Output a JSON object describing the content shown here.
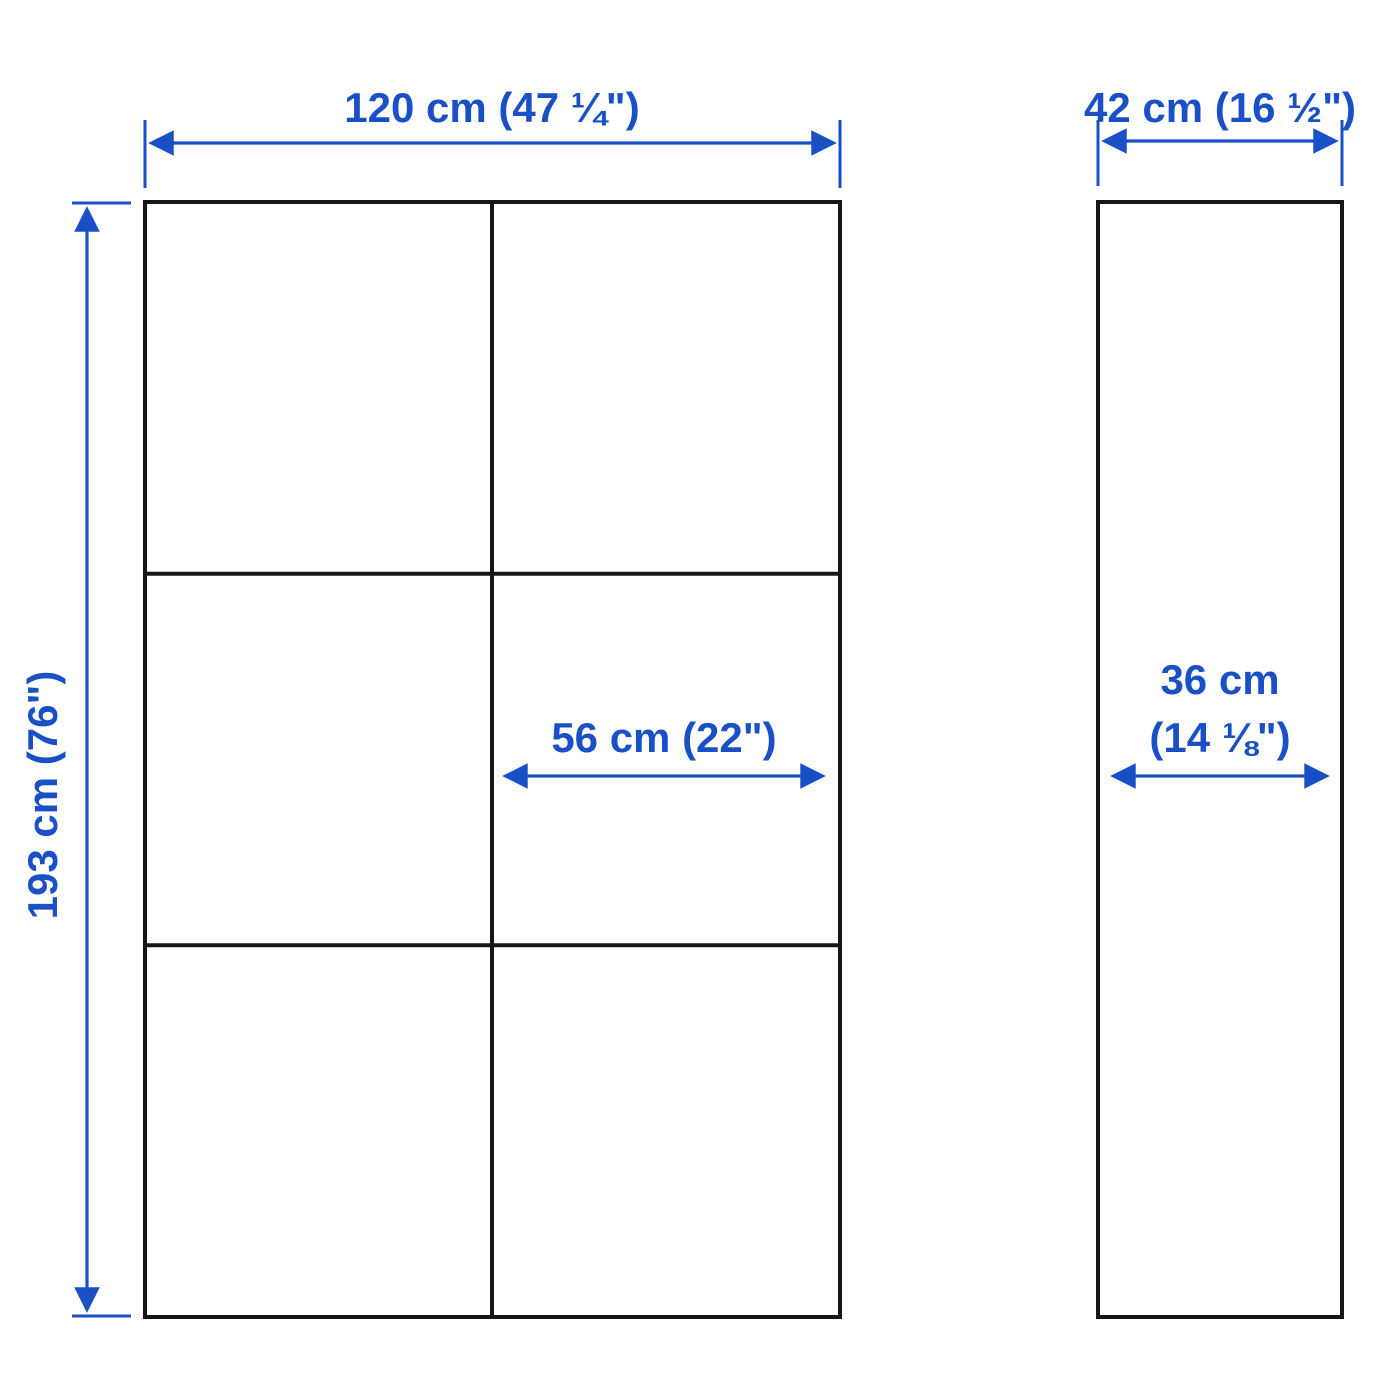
{
  "page": {
    "background": "#ffffff"
  },
  "colors": {
    "dimension_blue": "#1A50C6",
    "outline_black": "#161616"
  },
  "front_view": {
    "structure": "2 columns x 3 rows of equal compartments",
    "overall_width": "120 cm (47 ¼\")",
    "overall_height": "193 cm (76\")",
    "section_width": "56 cm (22\")"
  },
  "side_view": {
    "structure": "single tall empty rectangle",
    "overall_depth": "42 cm (16 ½\")",
    "inner_depth_line1": "36 cm",
    "inner_depth_line2": "(14 ⅛\")"
  }
}
